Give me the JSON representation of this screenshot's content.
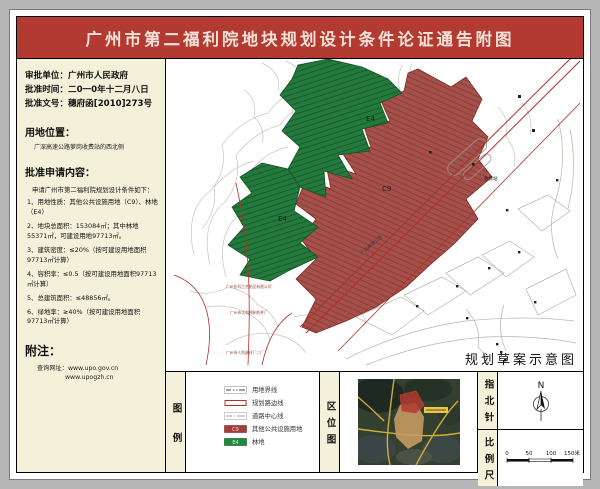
{
  "title": "广州市第二福利院地块规划设计条件论证通告附图",
  "info_panel": {
    "approval_unit_label": "审批单位：",
    "approval_unit_value": "广州市人民政府",
    "approval_time_label": "批准时间：",
    "approval_time_value": "二0一0年十二月八日",
    "approval_doc_label": "批准文号：",
    "approval_doc_value": "穗府函[2010]273号",
    "location_heading": "用地位置：",
    "location_value": "广深高速公路萝岗收费站的西北侧",
    "approved_content": {
      "heading": "批准申请内容：",
      "intro": "申请广州市第二福利院规划设计条件如下：",
      "items": [
        "1、用地性质：其他公共设施用地（C9）、林地（E4）",
        "2、地块总面积：153084㎡；其中林地55371㎡，可建设用地97713㎡。",
        "3、建筑密度：≤20%（按可建设用地面积97713㎡计算）",
        "4、容积率：≤0.5（按可建设用地面积97713㎡计算）",
        "5、总建筑面积：≤48856㎡。",
        "6、绿地率：≥40%（按可建设用地面积97713㎡计算）"
      ]
    },
    "notes_heading": "附注：",
    "notes_site_label": "查询网址：",
    "notes_site1": "www.upo.gov.cn",
    "notes_site2": "www.upogzh.cn"
  },
  "map": {
    "caption": "规划草案示意图",
    "zone_c9": "C9",
    "zone_e4_upper": "E4",
    "zone_e4_lower": "E4",
    "label_toll": "收费站",
    "label_expressway": "广深高速公路",
    "label_factory1": "广州东科工艺制品有限公司",
    "label_factory2": "广州市太和预制构件厂",
    "label_factory3": "广州市人防器材厂二厂"
  },
  "legend": {
    "panel_label": "图例",
    "items": [
      {
        "label": "用地界线"
      },
      {
        "label": "规划路边线"
      },
      {
        "label": "道路中心线"
      },
      {
        "chip": "C9",
        "label": "其他公共设施用地"
      },
      {
        "chip": "E4",
        "label": "林地"
      }
    ]
  },
  "location_map": {
    "panel_label": "区位图"
  },
  "north_arrow": {
    "panel_label": "指北针",
    "letter": "N"
  },
  "scale_bar": {
    "panel_label": "比例尺",
    "ticks": [
      "0",
      "50",
      "100",
      "150米"
    ]
  },
  "colors": {
    "title_red": "#b23a30",
    "panel_cream": "#f4f1da",
    "zone_c9_fill": "#a5504a",
    "zone_e4_fill": "#237a3c",
    "road_red": "#b03028",
    "contour_gray": "#c9c5bd"
  }
}
